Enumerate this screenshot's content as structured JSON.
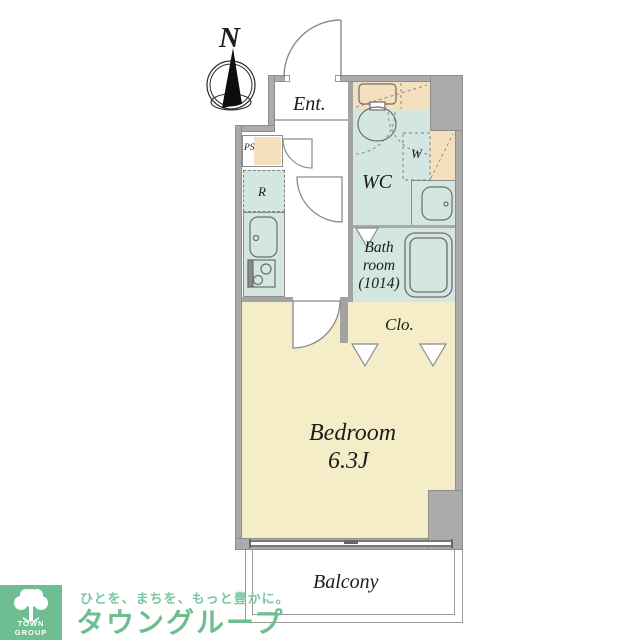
{
  "plan": {
    "labels": {
      "north": "N",
      "entrance": "Ent.",
      "pipe_space": "PS",
      "refrigerator": "R",
      "wc": "WC",
      "washer": "W",
      "bath_line1": "Bath",
      "bath_line2": "room",
      "bath_line3": "(1014)",
      "closet": "Clo.",
      "bedroom": "Bedroom",
      "bedroom_size": "6.3J",
      "balcony": "Balcony"
    },
    "colors": {
      "wall_gray": "#ababab",
      "mint": "#d4e6e1",
      "tan": "#f4e0bd",
      "cream": "#f5edc8",
      "line_gray": "#8d8d8d"
    }
  },
  "footer": {
    "logo_text": "TOWN GROUP",
    "tagline": "ひとを、まちを、もっと豊かに。",
    "brand": "タウングループ",
    "brand_color": "#6fbe92"
  }
}
